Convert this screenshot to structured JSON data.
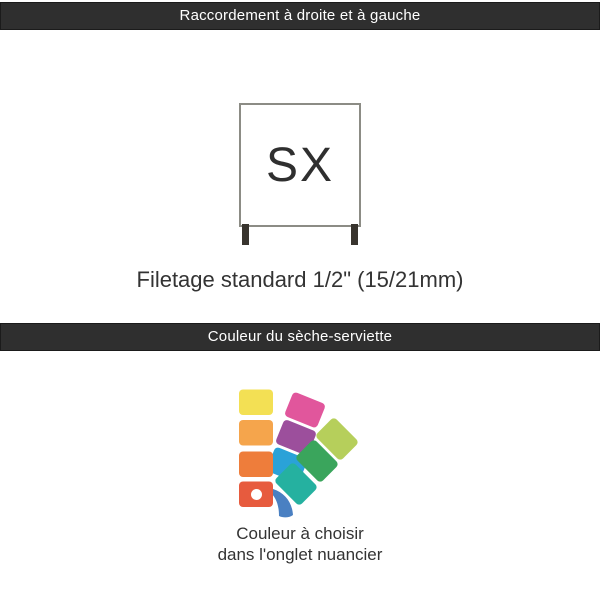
{
  "header_bar_1": {
    "title": "Raccordement à droite et à gauche"
  },
  "diagram": {
    "label": "SX",
    "caption": "Filetage standard 1/2\" (15/21mm)"
  },
  "header_bar_2": {
    "title": "Couleur du sèche-serviette"
  },
  "nuancier": {
    "icon": "color-swatch-fan-icon",
    "caption_line1": "Couleur à choisir",
    "caption_line2": "dans l'onglet nuancier",
    "colors": {
      "yellow": "#f3e054",
      "light_orange": "#f5a54c",
      "orange": "#ee7d3b",
      "red": "#e75b3e",
      "pink": "#e1569c",
      "purple": "#9c4f9c",
      "cyan": "#2aa2d8",
      "lime": "#b6cf5b",
      "green": "#3aa55c",
      "teal": "#25b1a0",
      "blue_handle": "#4a80c2",
      "dot": "#ffffff"
    }
  },
  "theme": {
    "bar_background": "#2f2f2f",
    "bar_border": "#1b1b1b",
    "bar_text": "#ffffff",
    "body_text": "#333333",
    "square_border": "#8c8c85",
    "leg_color": "#38342e",
    "page_background": "#ffffff"
  }
}
